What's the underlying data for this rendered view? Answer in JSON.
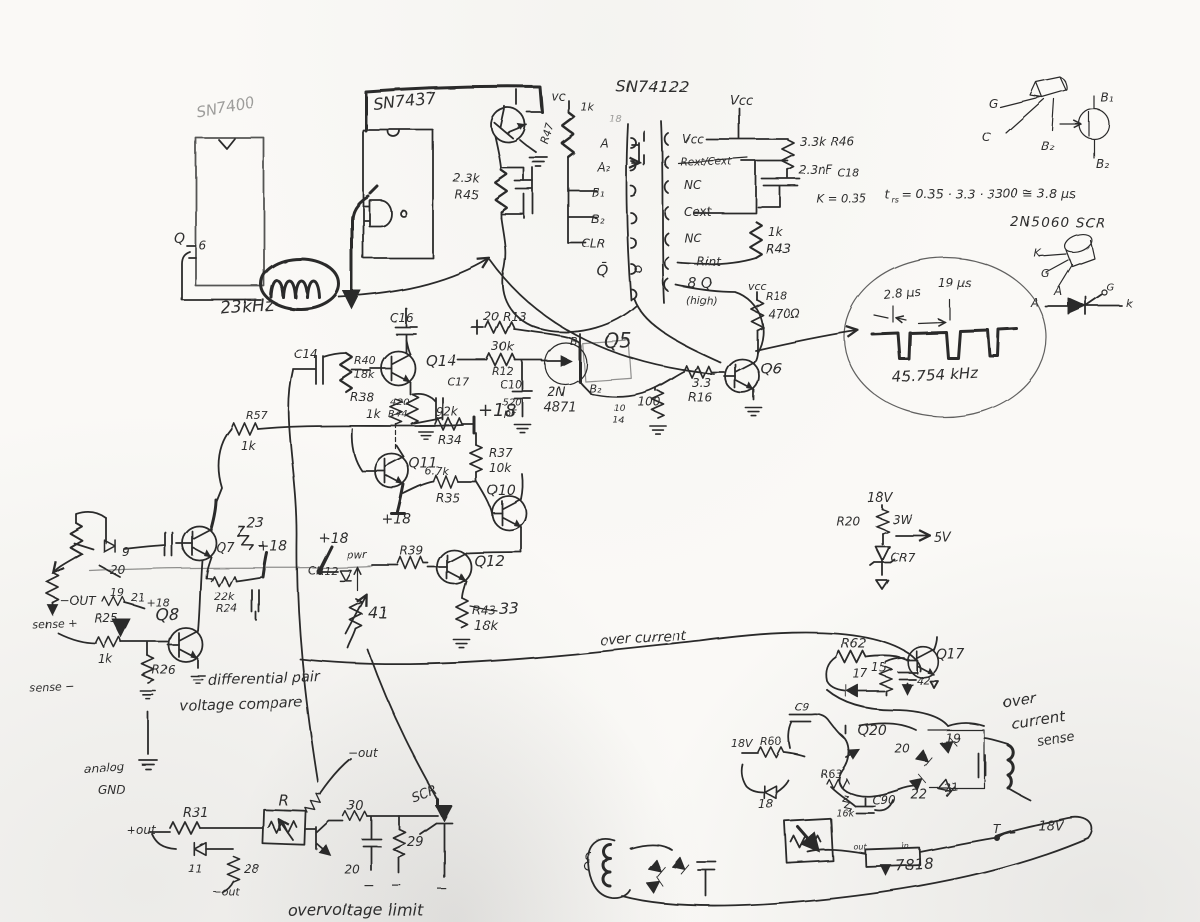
{
  "colors": {
    "ink": "#2c2c2c",
    "paper": "#faf9f6"
  },
  "labels": {
    "logic": {
      "ic1": "SN7400",
      "ic2": "SN7437",
      "q": "Q",
      "pin6": "6",
      "freq": "23kHz"
    },
    "driver": {
      "vc": "vc",
      "r47": "R47",
      "r47_val": "1k",
      "r45_val": "2.3k",
      "r45": "R45"
    },
    "oneshot": {
      "part": "SN74122",
      "pin_mark": "18",
      "a1": "A",
      "a2": "A₂",
      "b1": "B₁",
      "b2": "B₂",
      "clr": "CLR",
      "qbar": "Q̄",
      "vcc": "Vcc",
      "p1": "Vcc",
      "p2": "Rext/Cext",
      "p3": "NC",
      "p4": "Cext",
      "p5": "NC",
      "p6": "Rint",
      "p7": "8 Q",
      "p7n": "(high)",
      "r46_val": "3.3k",
      "r46": "R46",
      "c18_val": "2.3nF",
      "c18": "C18",
      "k": "K = 0.35",
      "r43_val": "1k",
      "r43": "R43",
      "vcc2": "vcc",
      "r18": "R18",
      "r18_val": "470Ω"
    },
    "pinout": {
      "g": "G",
      "c": "C",
      "b2": "B₂",
      "sym_b1": "B₁",
      "sym_b2": "B₂",
      "formula_t": "t",
      "formula_sub": "rs",
      "formula_rest": "= 0.35 · 3.3 · 3300 ≅ 3.8 μs",
      "scr_part": "2N5060  SCR",
      "k": "K",
      "g2": "G",
      "a": "A",
      "sym_a": "A",
      "sym_g": "G",
      "sym_k": "k"
    },
    "scope": {
      "t1": "2.8 μs",
      "t2": "19 μs",
      "freq": "45.754 kHz"
    },
    "osc": {
      "c16": "C16",
      "c14": "C14",
      "r40": "R40",
      "r40_val": "18k",
      "q14": "Q14",
      "c17": "C17",
      "r44_val": "420",
      "r44": "R44",
      "r38": "R38",
      "r38_val": "1k",
      "r13": "20  R13",
      "r12_val": "30k",
      "r12": "R12",
      "c10": "C10",
      "c10_val": "520",
      "c10_unit": "pF",
      "ujt_a": "2N",
      "ujt_b": "4871",
      "b1": "B₁",
      "b2": "B₂",
      "q5": "Q5",
      "r_100": "100",
      "n10": "10",
      "n14": "14",
      "r16_val": "3.3",
      "r16": "R16",
      "q6": "Q6"
    },
    "mid": {
      "r57": "R57",
      "r57_val": "1k",
      "r34_val": "92k",
      "r34": "R34",
      "p18a": "+18",
      "q11": "Q11",
      "p18b": "+18",
      "r35_val": "6.7k",
      "r35": "R35",
      "r37": "R37",
      "r37_val": "10k",
      "q10": "Q10",
      "r39": "R39",
      "q12": "Q12",
      "r43": "R43",
      "v33": "33",
      "v18k": "18k",
      "p18c": "+18",
      "cr12": "CR12",
      "pwr": "pwr",
      "r41": "41"
    },
    "diff": {
      "d9": "9",
      "d20": "20",
      "d19": "19",
      "d21": "21",
      "p18a": "+18",
      "r25": "R25",
      "q8": "Q8",
      "q7": "Q7",
      "r23": "23",
      "p18b": "+18",
      "r24_val": "22k",
      "r24": "R24",
      "neg_out": "−OUT",
      "sense_p": "sense +",
      "r1k": "1k",
      "r26": "R26",
      "sense_n": "sense −",
      "cap1": "differential pair",
      "cap2": "voltage compare",
      "agnd1": "analog",
      "agnd2": "GND"
    },
    "pwr5": {
      "v18": "18V",
      "r20": "R20",
      "w3": "3W",
      "v5": "5V",
      "cr7": "CR7"
    },
    "oc": {
      "label": "over current"
    },
    "ovp": {
      "pos_out": "+out",
      "r31": "R31",
      "d11": "11",
      "r28": "28",
      "neg_out1": "−out",
      "r": "R",
      "neg_out2": "−out",
      "r30": "30",
      "c20": "20",
      "r29": "29",
      "scr": "SCR",
      "minus1": "−",
      "minus2": "−",
      "minus3": "−",
      "caption": "overvoltage limit"
    },
    "ocs": {
      "r62": "R62",
      "q17": "Q17",
      "d17": "17",
      "r15": "15",
      "c42": "42",
      "t1": "over",
      "t2": "current",
      "t3": "sense",
      "c9": "C9",
      "v18a": "18V",
      "r60": "R60",
      "q20": "Q20",
      "r63": "R63",
      "d18": "18",
      "r16k": "16k",
      "c90": "C90",
      "d19": "19",
      "d20": "20",
      "d21": "21",
      "d22": "22",
      "reg": "7818",
      "reg_out": "out",
      "reg_in": "in",
      "v18b": "18V",
      "t": "T"
    }
  }
}
